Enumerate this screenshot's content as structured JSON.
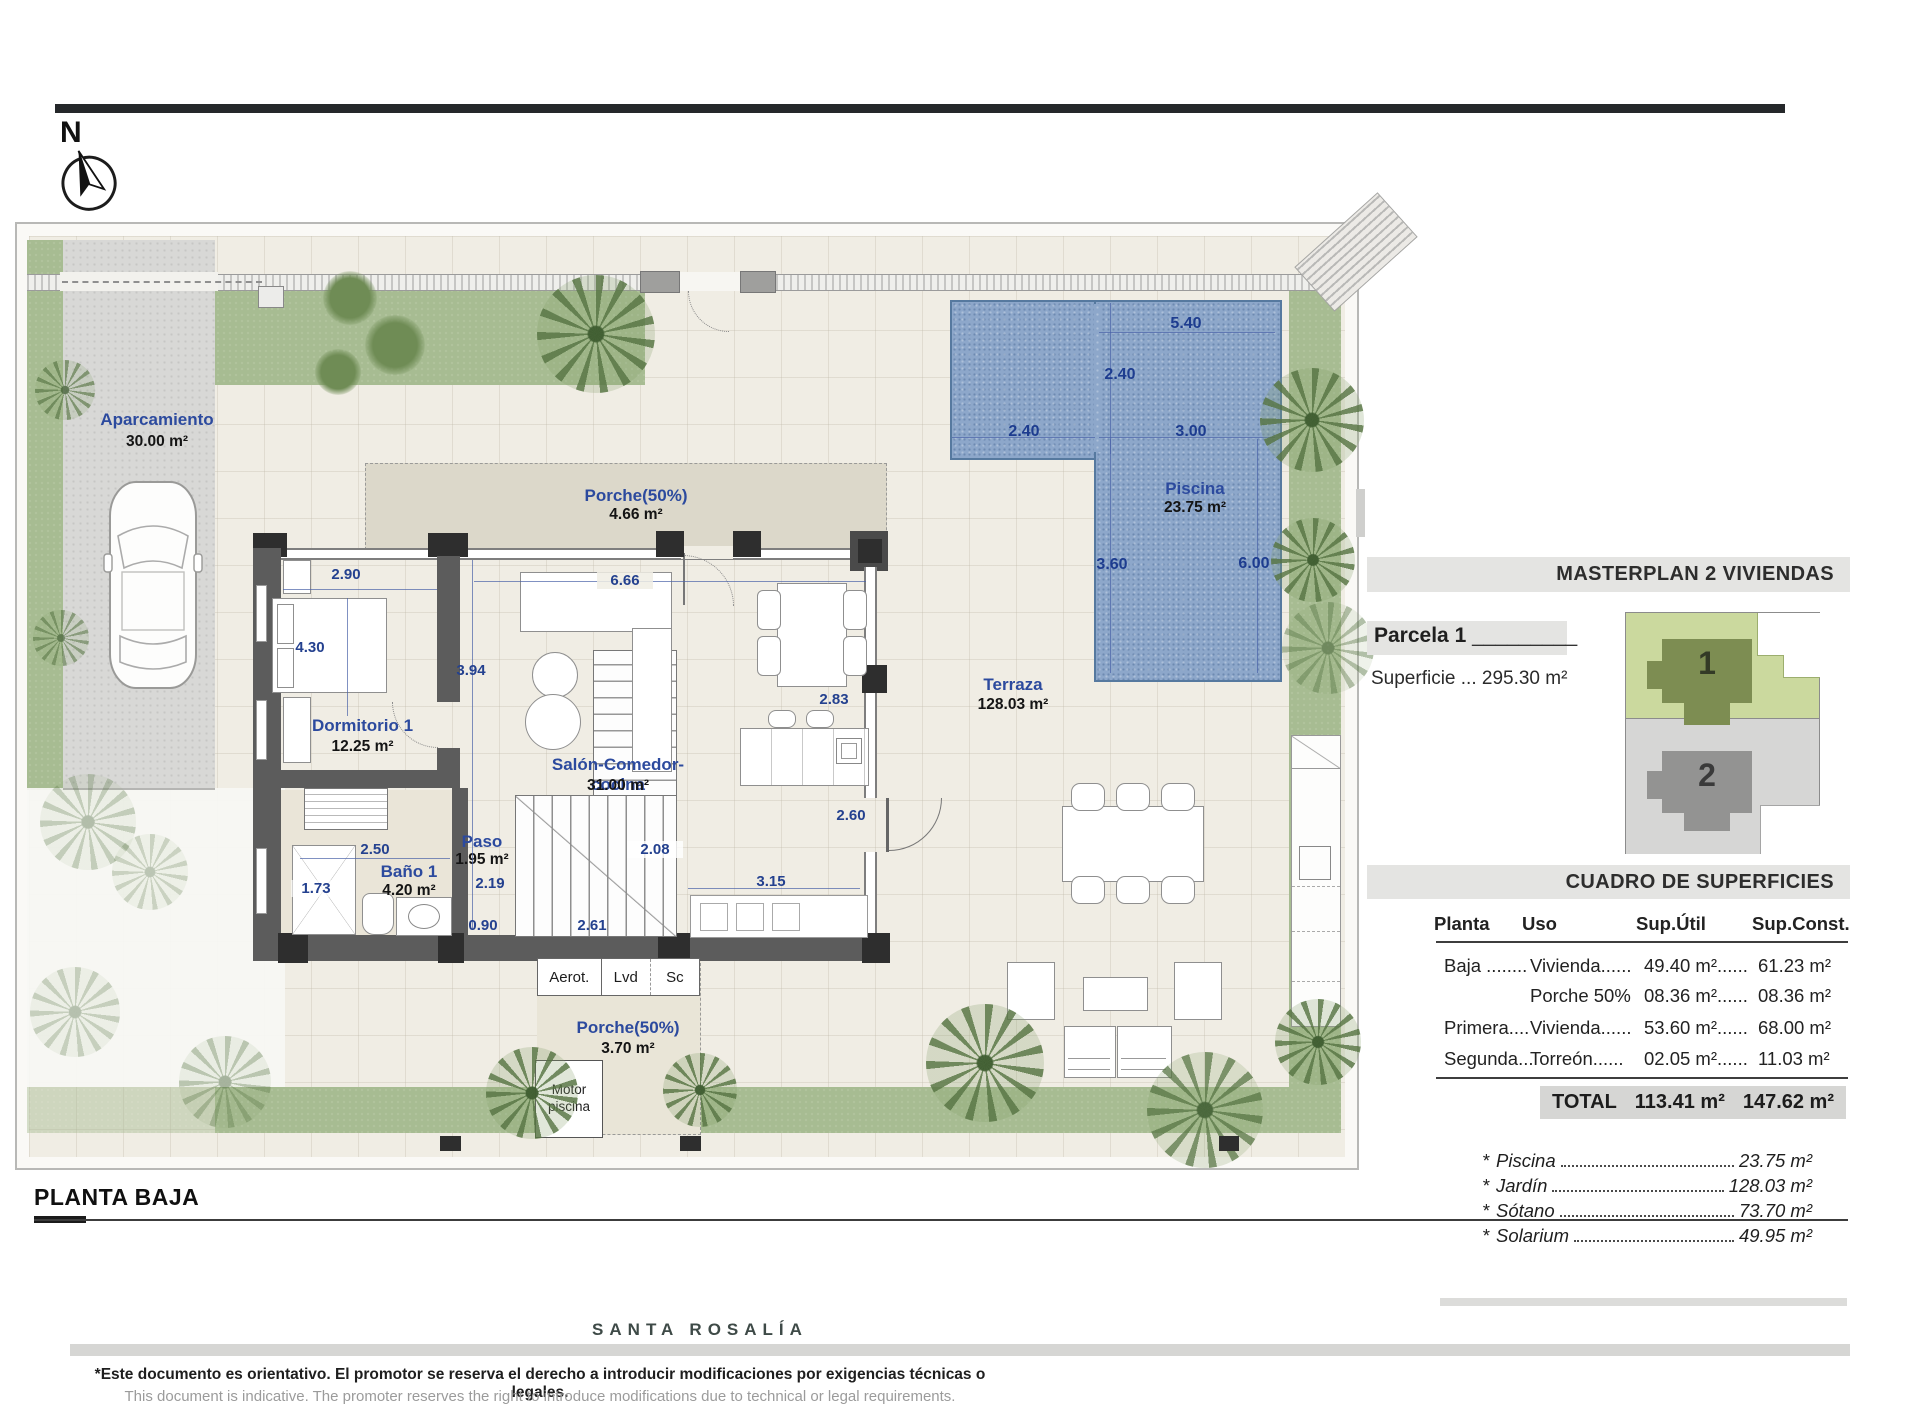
{
  "colors": {
    "pool": "#8da7ca",
    "grass": "#a7bc92",
    "wall": "#5c5c5c",
    "dim_text": "#24418f",
    "room_label": "#2c4a9e",
    "header_bg": "#e4e4e2"
  },
  "icons": {
    "compass": "north-compass",
    "car": "car-top-view",
    "palm": "palm-tree"
  },
  "north_label": "N",
  "rooms": {
    "aparcamiento": {
      "name": "Aparcamiento",
      "area": "30.00 m²"
    },
    "porche_top": {
      "name": "Porche(50%)",
      "area": "4.66 m²"
    },
    "dormitorio": {
      "name": "Dormitorio 1",
      "area": "12.25 m²"
    },
    "salon": {
      "name": "Salón-Comedor-cocina",
      "area": "31.00 m²"
    },
    "bano": {
      "name": "Baño 1",
      "area": "4.20 m²"
    },
    "paso": {
      "name": "Paso",
      "area": "1.95 m²"
    },
    "terraza": {
      "name": "Terraza",
      "area": "128.03 m²"
    },
    "piscina": {
      "name": "Piscina",
      "area": "23.75 m²"
    },
    "porche_bottom": {
      "name": "Porche(50%)",
      "area": "3.70 m²"
    },
    "motor": "Motor piscina",
    "utility": [
      "Aerot.",
      "Lvd",
      "Sc"
    ]
  },
  "dims": {
    "bedroom_width": "2.90",
    "bedroom_depth": "4.30",
    "hall_height": "3.94",
    "salon_width": "6.66",
    "salon_depth": "2.83",
    "kitchen_depth": "2.60",
    "kitchen_width": "3.15",
    "stair_width": "2.61",
    "stair_depth": "2.08",
    "hall_width": "0.90",
    "hall_upper": "2.19",
    "bath_width": "2.50",
    "bath_depth": "1.73",
    "pool_top": "5.40",
    "pool_arm_depth": "2.40",
    "pool_arm_width": "2.40",
    "pool_width": "3.00",
    "pool_left": "3.60",
    "pool_right": "6.00"
  },
  "panel": {
    "masterplan_title": "MASTERPLAN 2 VIVIENDAS",
    "parcela_label": "Parcela 1",
    "parcela_line": "_________",
    "superficie": "Superficie ... 295.30 m²",
    "unit1": "1",
    "unit2": "2",
    "cuadro_title": "CUADRO DE SUPERFICIES",
    "table": {
      "headers": [
        "Planta",
        "Uso",
        "Sup.Útil",
        "Sup.Const."
      ],
      "rows": [
        [
          "Baja ........",
          "Vivienda......",
          "49.40 m²......",
          "61.23 m²"
        ],
        [
          "",
          "Porche 50%",
          "08.36 m²......",
          "08.36 m²"
        ],
        [
          "Primera....",
          "Vivienda......",
          "53.60 m²......",
          "68.00 m²"
        ],
        [
          "Segunda...",
          "Torreón......",
          "02.05 m²......",
          "11.03 m²"
        ]
      ],
      "total_label": "TOTAL",
      "total_util": "113.41 m²",
      "total_const": "147.62 m²"
    },
    "extras": [
      {
        "star": "*",
        "name": "Piscina",
        "value": "23.75 m²"
      },
      {
        "star": "*",
        "name": "Jardín",
        "value": "128.03 m²"
      },
      {
        "star": "*",
        "name": "Sótano",
        "value": "73.70 m²"
      },
      {
        "star": "*",
        "name": "Solarium",
        "value": "49.95 m²"
      }
    ]
  },
  "footer": {
    "plan_title": "PLANTA BAJA",
    "brand": "SANTA ROSALÍA",
    "disclaimer_es": "*Este documento es orientativo. El promotor se reserva el derecho a introducir modificaciones por exigencias técnicas o legales.",
    "disclaimer_en": "This document is indicative. The promoter reserves the right to introduce modifications due to technical or legal requirements."
  }
}
